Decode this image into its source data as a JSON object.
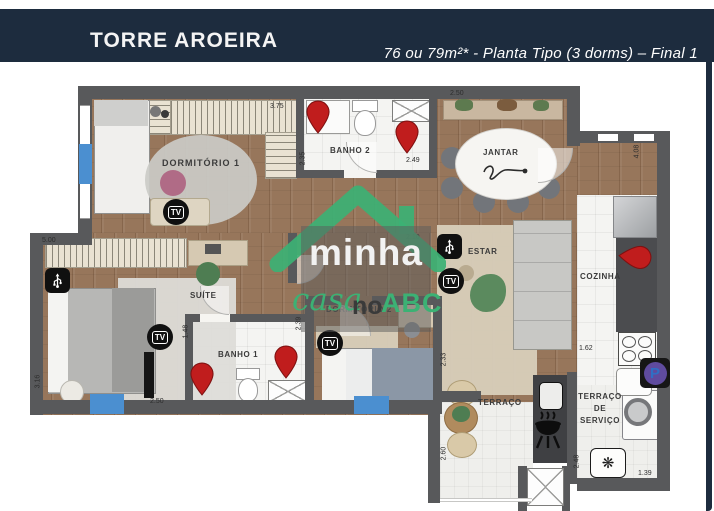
{
  "header": {
    "title": "TORRE AROEIRA",
    "subtitle": "76 ou 79m²* - Planta Tipo  (3 dorms) – Final 1"
  },
  "watermark": {
    "word1": "minha",
    "word2": "casa",
    "word3": "no",
    "word4": "ABC"
  },
  "rooms": {
    "dormitorio1": "DORMITÓRIO 1",
    "banho2": "BANHO 2",
    "jantar": "JANTAR",
    "estar": "ESTAR",
    "cozinha": "COZINHA",
    "suite": "SUÍTE",
    "banho1": "BANHO 1",
    "dormitorio2": "DORMITÓRIO 2",
    "terraco": "TERRAÇO",
    "servico_l1": "TERRAÇO",
    "servico_l2": "DE",
    "servico_l3": "SERVIÇO"
  },
  "dimensions": {
    "dorm1_width": "3.75",
    "jantar_width": "2.50",
    "banho2_height": "2.35",
    "banho2_width": "2.49",
    "right_height": "4.08",
    "hall_width": "2.10",
    "suite_width": "5.00",
    "suite_height": "3.16",
    "suite_bottom": "2.50",
    "banho1_height": "1.48",
    "dorm2_left": "2.39",
    "dorm2_right": "2.33",
    "cozinha_width": "1.62",
    "terraco_height": "2.60",
    "servico_height": "2.48",
    "servico_width": "1.39"
  },
  "icons": {
    "tv": "TV",
    "parking": "P"
  },
  "colors": {
    "header_navy": "#1d2c3e",
    "wall_gray": "#58595b",
    "pin_red": "#c01d1d",
    "logo_green": "#3cb174",
    "marker_blue": "#4b8fd0",
    "parking_purple": "#5f4b9e"
  }
}
